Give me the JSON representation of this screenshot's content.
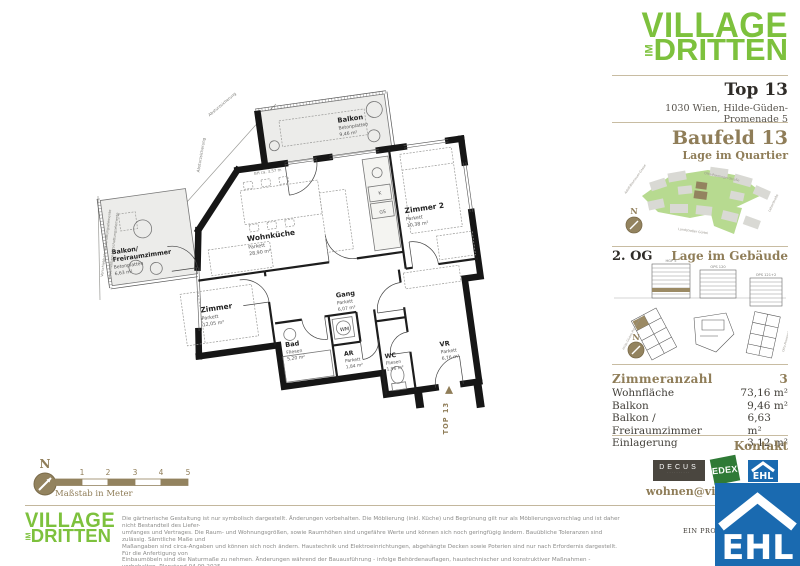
{
  "brand": {
    "line1": "VILLAGE",
    "im": "IM",
    "line2": "DRITTEN"
  },
  "header": {
    "unit": "Top 13",
    "address": "1030 Wien, Hilde-Güden-Promenade 5"
  },
  "quartier": {
    "title": "Baufeld 13",
    "subtitle": "Lage im Quartier",
    "north": "N",
    "streets": {
      "left": "Adolf-Blamauer-Gasse",
      "top": "Otto-Preminger-Straße",
      "bottom": "Landstraßer Gürtel",
      "right": "Leberstraße"
    }
  },
  "gebaeude": {
    "floor": "2. OG",
    "title": "Lage im Gebäude",
    "north": "N",
    "buildings": [
      {
        "label": "HGP 5"
      },
      {
        "label": "OPS 120"
      },
      {
        "label": "OPS 121+2"
      }
    ],
    "streets": {
      "left": "Hilde-Güden-Promenade",
      "right": "Otto-Preminger-Straße"
    }
  },
  "stats": {
    "rows": [
      {
        "label": "Zimmeranzahl",
        "value": "3"
      },
      {
        "label": "Wohnfläche",
        "value": "73,16 m²"
      },
      {
        "label": "Balkon",
        "value": "9,46 m²"
      },
      {
        "label": "Balkon / Freiraumzimmer",
        "value": "6,63 m²"
      },
      {
        "label": "Einlagerung",
        "value": "3,12 m²"
      }
    ]
  },
  "kontakt": {
    "title": "Kontakt",
    "email": "wohnen@villageimdritten.at",
    "partners": [
      {
        "name": "DECUS"
      },
      {
        "name": "EDEX"
      },
      {
        "name": "EHL"
      }
    ]
  },
  "plan": {
    "rooms": {
      "balkon": {
        "name": "Balkon",
        "floor": "Betonplatten",
        "area": "9,46 m²"
      },
      "freiraum": {
        "name1": "Balkon/",
        "name2": "Freiraumzimmer",
        "floor": "Betonplatten",
        "area": "6,63 m²"
      },
      "wohnkueche": {
        "name": "Wohnküche",
        "floor": "Parkett",
        "area": "28,90 m²"
      },
      "zimmer2": {
        "name": "Zimmer 2",
        "floor": "Parkett",
        "area": "10,38 m²"
      },
      "zimmer": {
        "name": "Zimmer",
        "floor": "Parkett",
        "area": "12,05 m²"
      },
      "gang": {
        "name": "Gang",
        "floor": "Parkett",
        "area": "6,07 m²"
      },
      "bad": {
        "name": "Bad",
        "floor": "Fliesen",
        "area": "5,20 m²"
      },
      "ar": {
        "name": "AR",
        "floor": "Parkett",
        "area": "1,84 m²"
      },
      "wc": {
        "name": "WC",
        "floor": "Fliesen",
        "area": "1,96 m²"
      },
      "vr": {
        "name": "VR",
        "floor": "Parkett",
        "area": "6,76 m²"
      },
      "wm": "WM",
      "k": "K",
      "gs": "GS"
    },
    "annotations": {
      "absturz1": "Absturzsicherung",
      "absturz2": "Absturzsicherung",
      "verschattung1": "Verschiebbare Verschattungselemente",
      "verschattung2": "Verschiebbare Verschattungselemente",
      "bh": "BH ca. 3,57 m",
      "top_label": "TOP 13"
    },
    "scale": {
      "north": "N",
      "label": "Maßstab in Meter",
      "ticks": [
        "1",
        "2",
        "3",
        "4",
        "5"
      ]
    }
  },
  "footer": {
    "disclaimer_lines": [
      "Die gärtnerische Gestaltung ist nur symbolisch dargestellt. Änderungen vorbehalten. Die Möblierung (inkl. Küche) und Begrünung gilt nur als Möblierungsvorschlag und ist daher nicht Bestandteil des Liefer-",
      "umfanges und Vertrages. Die Raum- und Wohnungsgrößen, sowie Raumhöhen sind ungefähre Werte und können sich noch geringfügig ändern. Bauübliche Toleranzen sind zulässig. Sämtliche Maße und",
      "Maßangaben sind circa-Angaben und können sich noch ändern. Haustechnik und Elektroeinrichtungen, abgehängte Decken sowie Poterien sind nur nach Erfordernis dargestellt. Für die Anfertigung von",
      "Einbaumöbeln sind die Naturmaße zu nehmen. Änderungen während der Bauausführung - infolge Behördenauflagen, haustechnischer und konstruktiver Maßnahmen - vorbehalten. Planstand 04.09.2025"
    ],
    "project_note": "EIN PROJEKT VON"
  },
  "colors": {
    "brand_green": "#7dc13d",
    "accent_brown": "#8f7d58",
    "ehl_blue": "#1a6ab0",
    "edex_green": "#2f7a36"
  }
}
